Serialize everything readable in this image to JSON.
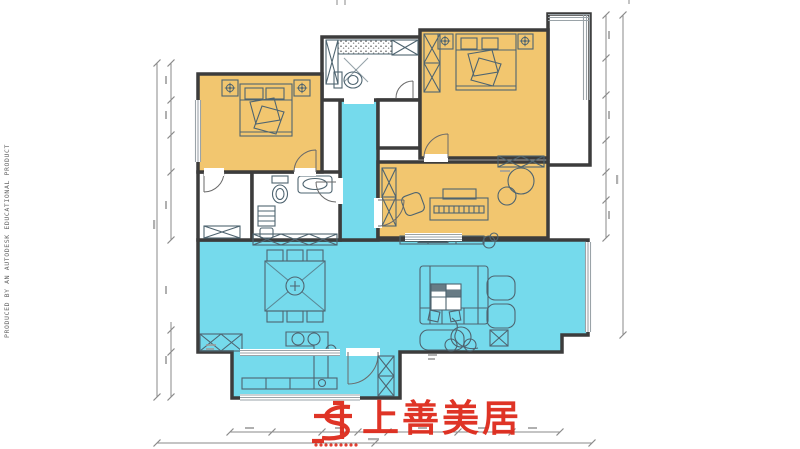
{
  "stamp": {
    "text": "PRODUCED BY AN AUTODESK EDUCATIONAL PRODUCT"
  },
  "brand": {
    "name": "上善美居"
  },
  "colors": {
    "warm_room": "#F2C66F",
    "cool_room": "#75DAEC",
    "wall": "#3C3C3C",
    "furniture": "#4E6470",
    "window": "#9AA3A8",
    "dimension": "#8A8A8A",
    "brand_red": "#DE2A1B"
  }
}
